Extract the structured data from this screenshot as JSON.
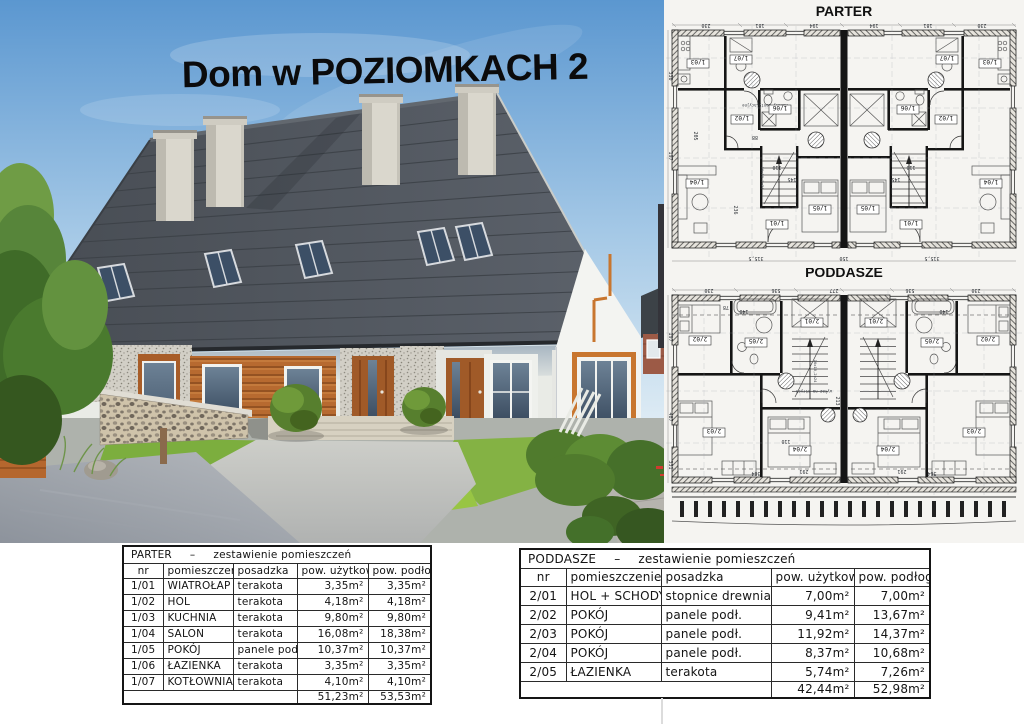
{
  "title": "Dom w POZIOMKACH 2",
  "plans": {
    "parter": {
      "label": "PARTER",
      "rooms": [
        "1/03",
        "1/07",
        "1/06",
        "1/02",
        "1/01",
        "1/05",
        "1/04"
      ],
      "dims": [
        "230",
        "181",
        "194",
        "330",
        "197",
        "315,5",
        "150",
        "110",
        "145",
        "236",
        "88",
        "205"
      ],
      "stairs": "16x18,2x24",
      "note": "kanały wentylacyjne"
    },
    "poddasze": {
      "label": "PODDASZE",
      "rooms": [
        "2/02",
        "2/05",
        "2/01",
        "2/03",
        "2/04"
      ],
      "dims": [
        "230",
        "536",
        "277",
        "140",
        "197",
        "487",
        "331",
        "364",
        "291",
        "213",
        "110",
        "78"
      ],
      "stairs": "16x18,2x24",
      "note": "wyłaz na strych"
    }
  },
  "tables": {
    "parter": {
      "title": {
        "floor": "PARTER",
        "dash": "–",
        "caption": "zestawienie pomieszczeń"
      },
      "columns": {
        "nr": "nr",
        "room": "pomieszczenie",
        "floor": "posadzka",
        "use": "pow. użytkowa",
        "pod": "pow. podłogi"
      },
      "rows": [
        {
          "nr": "1/01",
          "room": "WIATROŁAP",
          "floor": "terakota",
          "use": "3,35m²",
          "pod": "3,35m²"
        },
        {
          "nr": "1/02",
          "room": "HOL",
          "floor": "terakota",
          "use": "4,18m²",
          "pod": "4,18m²"
        },
        {
          "nr": "1/03",
          "room": "KUCHNIA",
          "floor": "terakota",
          "use": "9,80m²",
          "pod": "9,80m²"
        },
        {
          "nr": "1/04",
          "room": "SALON",
          "floor": "terakota",
          "use": "16,08m²",
          "pod": "18,38m²"
        },
        {
          "nr": "1/05",
          "room": "POKÓJ",
          "floor": "panele podł.",
          "use": "10,37m²",
          "pod": "10,37m²"
        },
        {
          "nr": "1/06",
          "room": "ŁAZIENKA",
          "floor": "terakota",
          "use": "3,35m²",
          "pod": "3,35m²"
        },
        {
          "nr": "1/07",
          "room": "KOTŁOWNIA",
          "floor": "terakota",
          "use": "4,10m²",
          "pod": "4,10m²"
        }
      ],
      "total": {
        "use": "51,23m²",
        "pod": "53,53m²"
      }
    },
    "poddasze": {
      "title": {
        "floor": "PODDASZE",
        "dash": "–",
        "caption": "zestawienie pomieszczeń"
      },
      "columns": {
        "nr": "nr",
        "room": "pomieszczenie",
        "floor": "posadzka",
        "use": "pow. użytkowa",
        "pod": "pow. podłogi"
      },
      "rows": [
        {
          "nr": "2/01",
          "room": "HOL + SCHODY",
          "floor": "stopnice drewniane",
          "use": "7,00m²",
          "pod": "7,00m²"
        },
        {
          "nr": "2/02",
          "room": "POKÓJ",
          "floor": "panele podł.",
          "use": "9,41m²",
          "pod": "13,67m²"
        },
        {
          "nr": "2/03",
          "room": "POKÓJ",
          "floor": "panele podł.",
          "use": "11,92m²",
          "pod": "14,37m²"
        },
        {
          "nr": "2/04",
          "room": "POKÓJ",
          "floor": "panele podł.",
          "use": "8,37m²",
          "pod": "10,68m²"
        },
        {
          "nr": "2/05",
          "room": "ŁAZIENKA",
          "floor": "terakota",
          "use": "5,74m²",
          "pod": "7,26m²"
        }
      ],
      "total": {
        "use": "42,44m²",
        "pod": "52,98m²"
      }
    }
  }
}
